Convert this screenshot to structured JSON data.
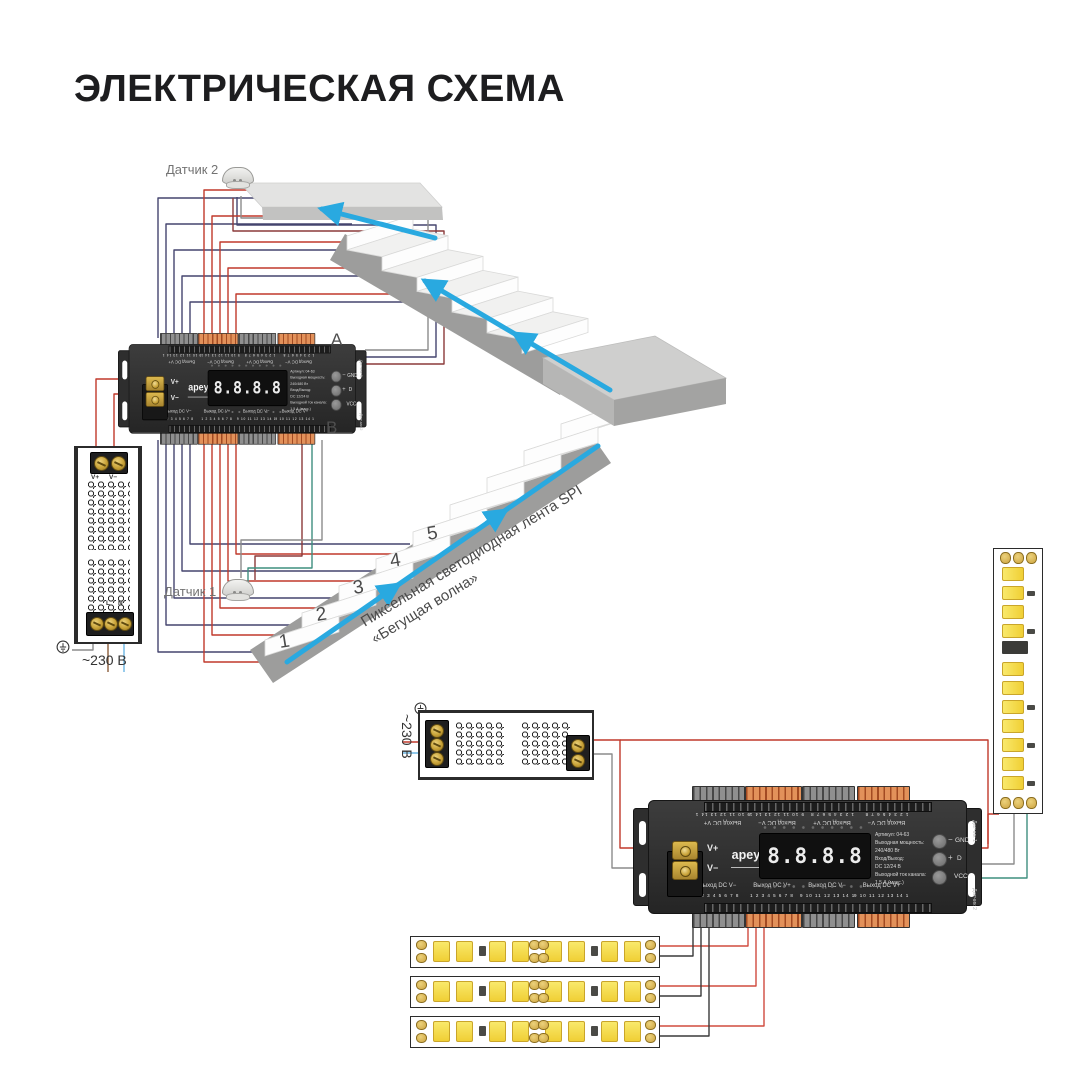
{
  "title": "ЭЛЕКТРИЧЕСКАЯ СХЕМА",
  "sensors": {
    "sensor1_label": "Датчик 1",
    "sensor2_label": "Датчик 2"
  },
  "stairs": {
    "step_numbers": [
      "1",
      "2",
      "3",
      "4",
      "5"
    ],
    "led_strip_label": "Пиксельная светодиодная лента SPI «Бегущая волна»"
  },
  "psu_left": {
    "v_plus": "V+",
    "v_minus": "V−",
    "l": "L",
    "n": "N",
    "mains": "~230 В"
  },
  "psu_bottom": {
    "mains": "~230 В"
  },
  "controller": {
    "brand": "apeyron",
    "brand_sub": "electric",
    "display_value": "8.8.8.8",
    "v_plus": "V+",
    "v_minus": "V−",
    "out_v_minus": "Выход DC V−",
    "out_v_plus": "Выход DC V+",
    "channels_left": "1 2 3 4 5 6 7 8",
    "channels_right": "9 10 11 12 13 14 15 16",
    "specs": [
      "Артикул: 04-63",
      "Выходная мощность:",
      "240/480 Вт",
      "Вход/Выход:",
      "DC 12/24 В",
      "Выходной ток канала:",
      "1,5 А (макс.)"
    ],
    "side": {
      "minus": "−",
      "plus": "+",
      "gnd": "GND",
      "d": "D",
      "vcc": "VCC",
      "sensor1": "Датчик 1",
      "sensor2": "Датчик 2"
    },
    "label_a": "A",
    "label_b": "B"
  },
  "colors": {
    "arrow_blue": "#29a9e0",
    "wire_red": "#c0392b",
    "wire_navy": "#45456f",
    "wire_green": "#3f8f7f",
    "terminal_orange": "#e2915a"
  }
}
